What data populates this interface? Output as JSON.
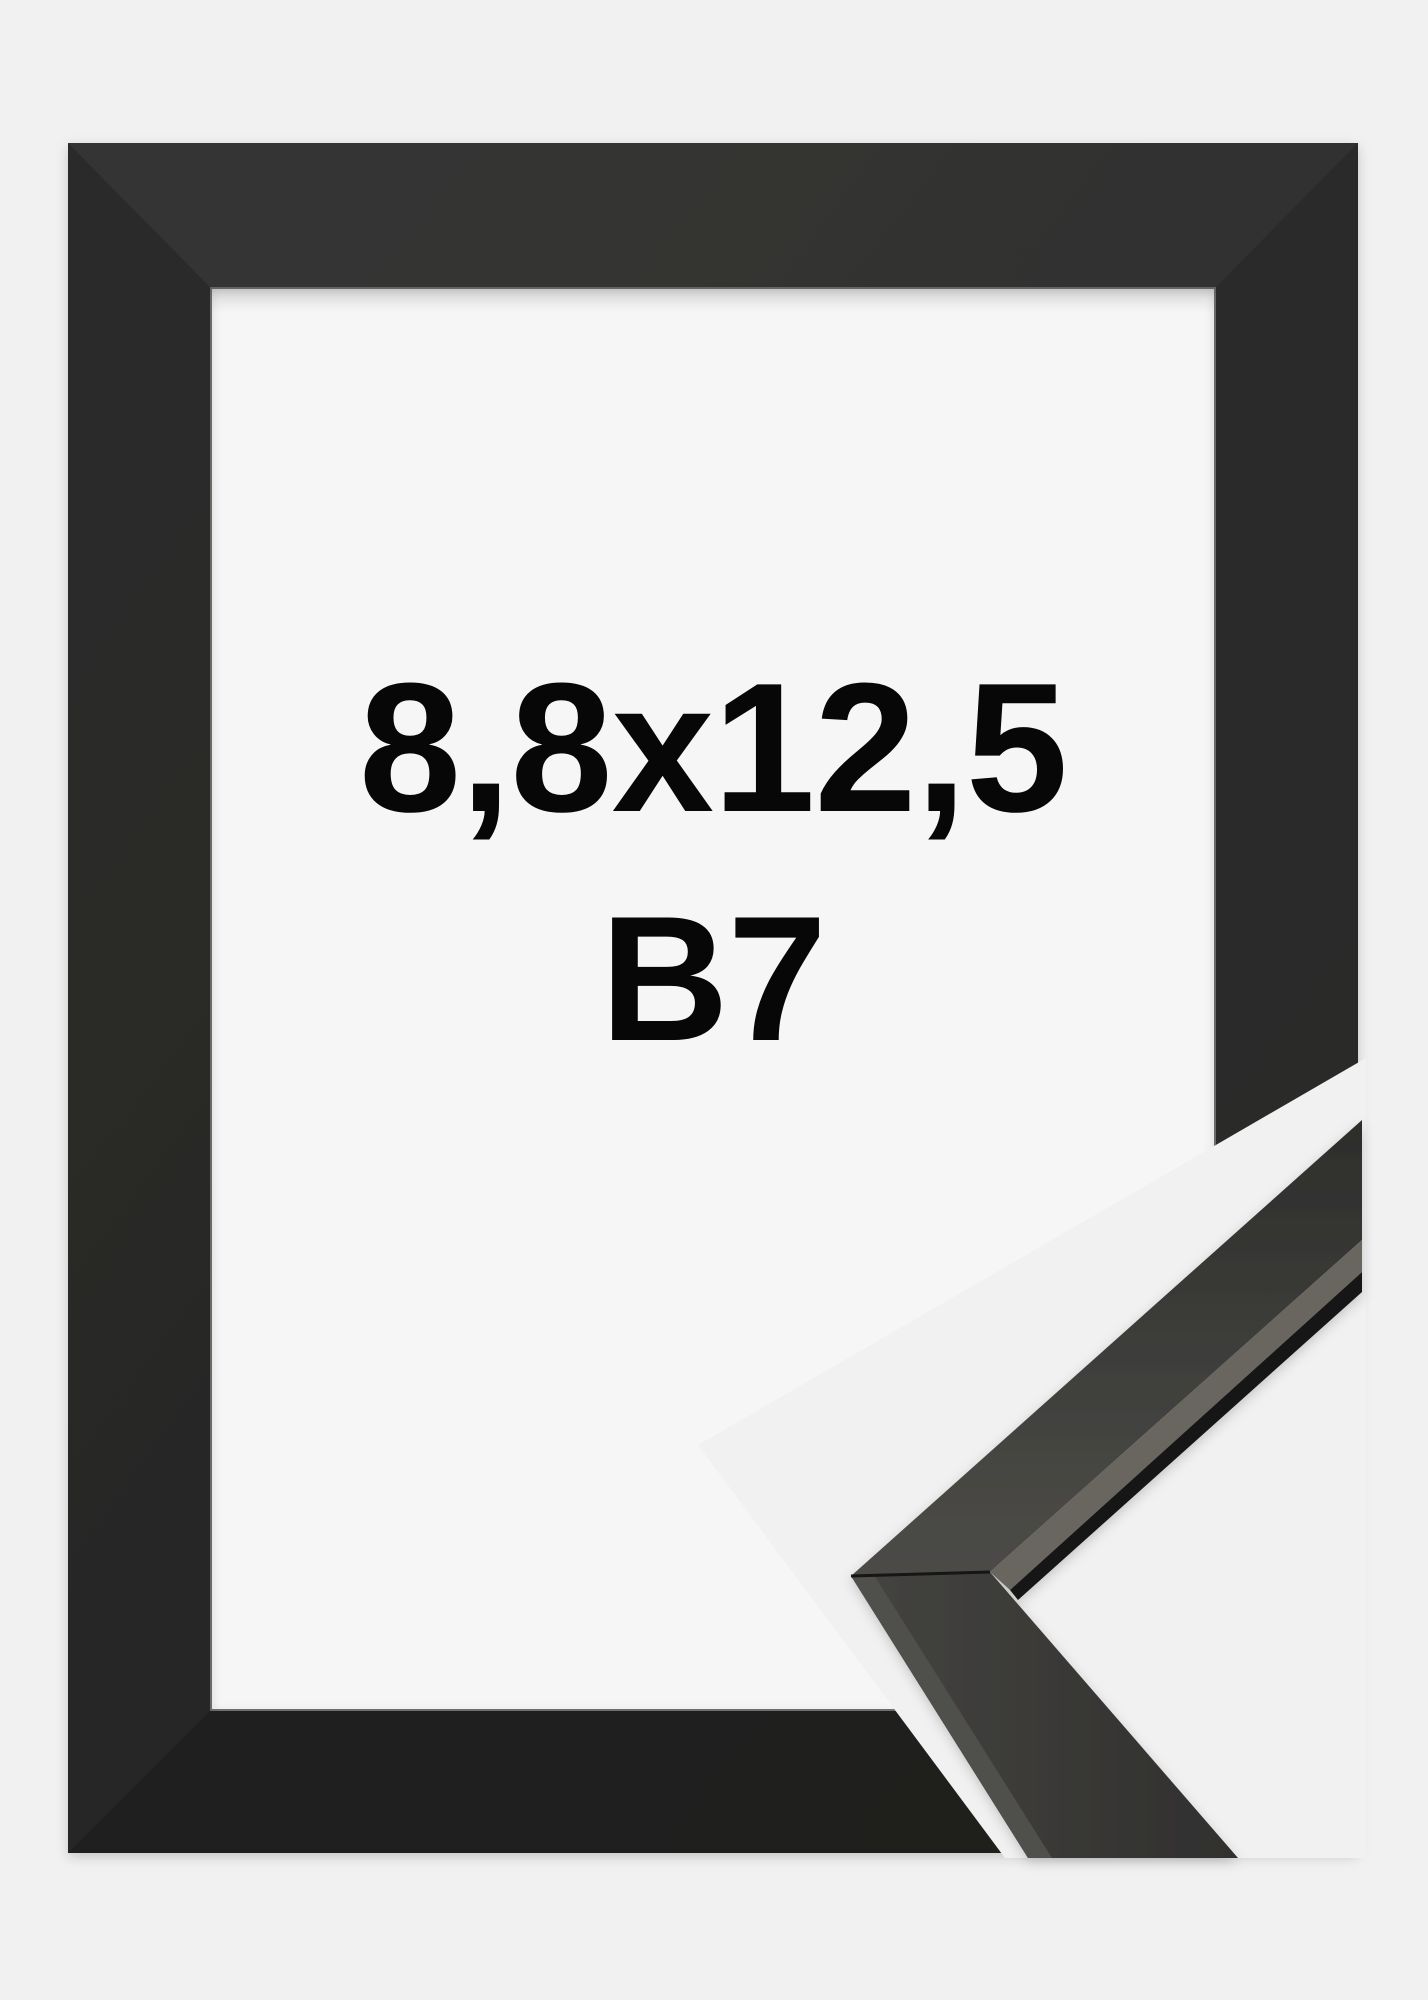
{
  "product_photo": {
    "size_label": "8,8x12,5",
    "format_label": "B7"
  },
  "colors": {
    "background": "#f1f1f2",
    "frame_window": "#f6f6f7",
    "frame_black": "#272726",
    "frame_bottom_shade": "#1f1f1e",
    "profile_face_dark": "#2f2f2d",
    "profile_face_light": "#474744",
    "profile_highlight": "#68665f",
    "profile_edge_dark": "#191918",
    "label_text": "#070707"
  },
  "icons": []
}
